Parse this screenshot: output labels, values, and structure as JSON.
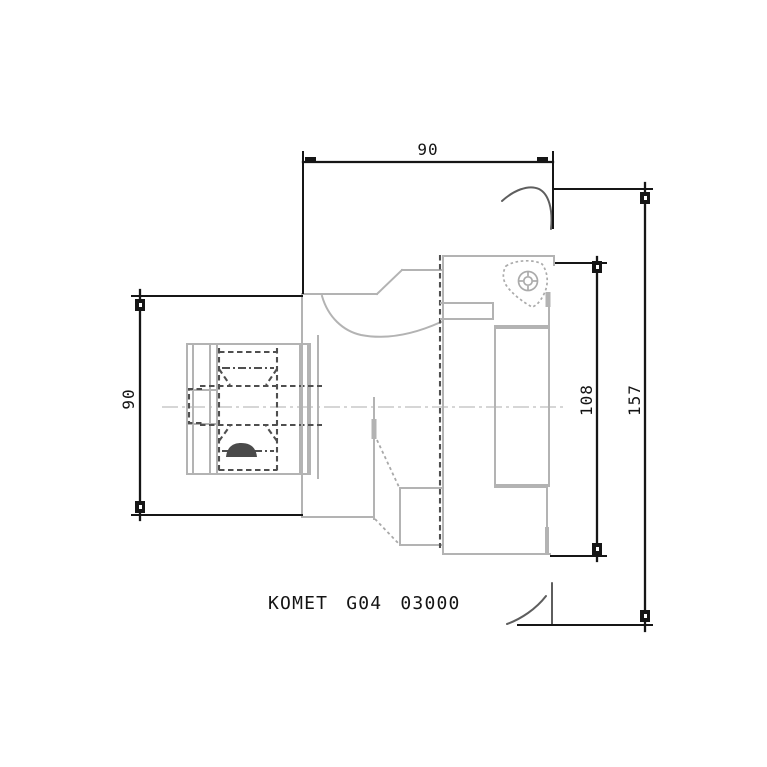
{
  "drawing": {
    "title": "KOMET G04 03000",
    "dimensions": {
      "top_length": "90",
      "left_diameter": "90",
      "head_diameter": "108",
      "flange_diameter": "157"
    },
    "colors": {
      "dimension_lines": "#161616",
      "body_lines": "#b3b3b3",
      "hidden_lines": "#4f4f4f",
      "centerline": "#c9c9c9"
    }
  }
}
